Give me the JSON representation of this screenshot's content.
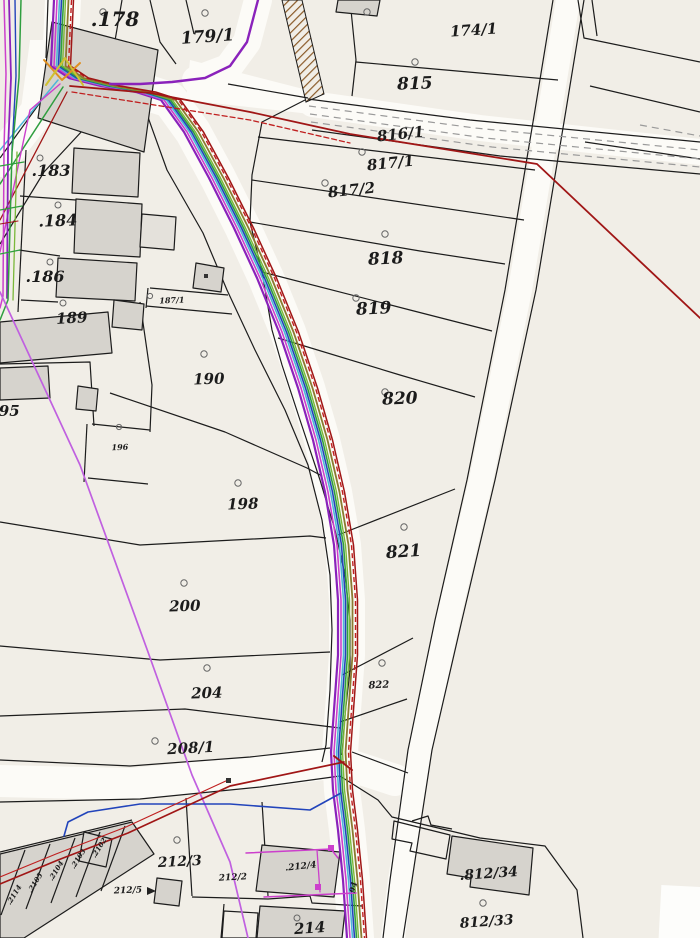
{
  "map": {
    "type": "cadastral-parcel-map",
    "background": "#f1eee7",
    "colors": {
      "boundary": "#1c1c1c",
      "building_fill": "#d6d3cd",
      "building_fill_light": "#e4e1db",
      "road_fill": "#fcfbf7",
      "dash_gray": "#9a9a9a",
      "marker_gray": "#666666",
      "power_red": "#a01616",
      "power_red_bright": "#c02020",
      "telecom_magenta": "#cc3fcc",
      "water_blue": "#2244bb",
      "gas_purple": "#8a22bb",
      "sewer_green": "#2f9e3f",
      "sewer_green_light": "#7ab83a",
      "cable_cyan": "#4fb6d8",
      "cable_olive": "#8a7a30",
      "line_violet": "#c060e0",
      "hatch_brown": "#8a5a28",
      "junction_orange": "#e09020",
      "junction_yellow": "#cfc030"
    },
    "labels": [
      {
        "text": ".178"
      },
      {
        "text": "179/1"
      },
      {
        "text": "174/1"
      },
      {
        "text": "815"
      },
      {
        "text": "816/1"
      },
      {
        "text": "817/1"
      },
      {
        "text": "817/2"
      },
      {
        "text": "818"
      },
      {
        "text": "819"
      },
      {
        "text": "820"
      },
      {
        "text": "821"
      },
      {
        "text": "822"
      },
      {
        "text": ".183"
      },
      {
        "text": ".184"
      },
      {
        "text": ".186"
      },
      {
        "text": "187/1"
      },
      {
        "text": "189"
      },
      {
        "text": "190"
      },
      {
        "text": "195"
      },
      {
        "text": "196"
      },
      {
        "text": "198"
      },
      {
        "text": "200"
      },
      {
        "text": "204"
      },
      {
        "text": "208/1"
      },
      {
        "text": "212/3"
      },
      {
        "text": "212/2"
      },
      {
        "text": "212/5"
      },
      {
        "text": ".212/4"
      },
      {
        "text": "214"
      },
      {
        "text": ".812/34"
      },
      {
        "text": "812/33"
      },
      {
        "text": ".2102"
      },
      {
        "text": ".2103"
      },
      {
        "text": ".2104"
      },
      {
        "text": ".2105"
      },
      {
        "text": ".2114"
      },
      {
        "text": "94"
      }
    ],
    "utility_bundle": {
      "path": [
        [
          63,
          0
        ],
        [
          60,
          66
        ],
        [
          78,
          78
        ],
        [
          110,
          86
        ],
        [
          145,
          92
        ],
        [
          170,
          100
        ],
        [
          193,
          132
        ],
        [
          218,
          178
        ],
        [
          243,
          228
        ],
        [
          266,
          278
        ],
        [
          288,
          332
        ],
        [
          307,
          388
        ],
        [
          322,
          440
        ],
        [
          334,
          492
        ],
        [
          343,
          545
        ],
        [
          347,
          600
        ],
        [
          347,
          655
        ],
        [
          343,
          710
        ],
        [
          340,
          752
        ],
        [
          342,
          790
        ],
        [
          347,
          830
        ],
        [
          352,
          880
        ],
        [
          356,
          938
        ]
      ],
      "lines": [
        {
          "name": "gas-purple",
          "dx": -9,
          "color": "#8a22bb",
          "width": 2.2
        },
        {
          "name": "telecom-magenta",
          "dx": -6,
          "color": "#cc3fcc",
          "width": 1.6
        },
        {
          "name": "cable-cyan",
          "dx": -3.5,
          "color": "#4fb6d8",
          "width": 1.6
        },
        {
          "name": "water-blue",
          "dx": -1.5,
          "color": "#2244bb",
          "width": 1.6
        },
        {
          "name": "sewer-green",
          "dx": 0.5,
          "color": "#2f9e3f",
          "width": 1.6
        },
        {
          "name": "sewer-green-light",
          "dx": 2.5,
          "color": "#7ab83a",
          "width": 1.4
        },
        {
          "name": "cable-olive",
          "dx": 5.5,
          "color": "#8a7a30",
          "width": 1.8
        },
        {
          "name": "power-red-dashed",
          "dx": 8.5,
          "color": "#c02020",
          "width": 1.4,
          "dash": "5,3"
        },
        {
          "name": "power-red",
          "dx": 10.5,
          "color": "#a01616",
          "width": 1.5
        }
      ]
    }
  }
}
